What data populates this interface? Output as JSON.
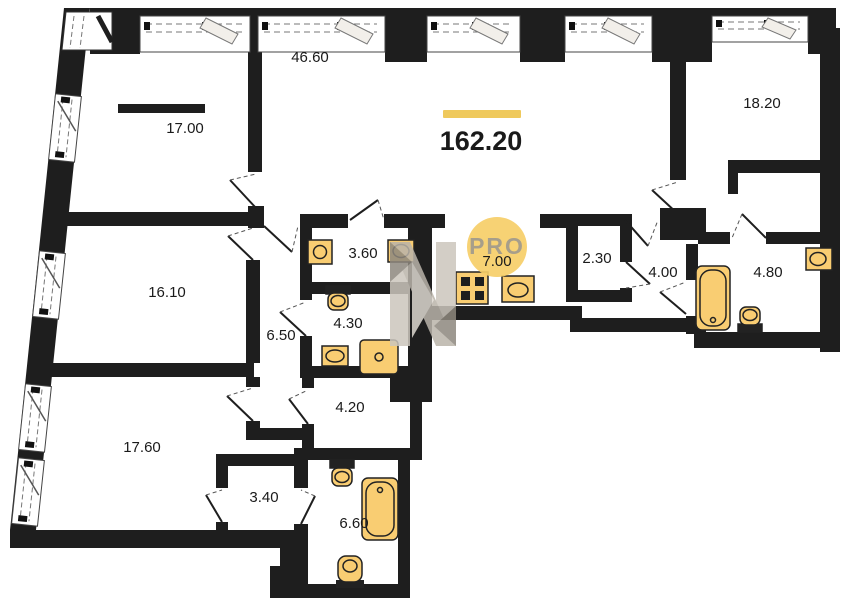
{
  "plan": {
    "type": "apartment-floor-plan",
    "total_area": {
      "value": "162.20",
      "accent_color": "#efc95c"
    },
    "watermark": {
      "text": "PRO",
      "circle_color": "#f6ce68",
      "logo": "faceted-N-logo"
    },
    "rooms": [
      {
        "name": "living-room",
        "area": "46.60"
      },
      {
        "name": "bedroom-top-left",
        "area": "17.00"
      },
      {
        "name": "bedroom-top-right",
        "area": "18.20"
      },
      {
        "name": "bedroom-mid-left",
        "area": "16.10"
      },
      {
        "name": "corridor",
        "area": "6.50"
      },
      {
        "name": "bathroom-a",
        "area": "3.60"
      },
      {
        "name": "bathroom-b",
        "area": "4.30"
      },
      {
        "name": "kitchen",
        "area": "7.00"
      },
      {
        "name": "wardrobe",
        "area": "2.30"
      },
      {
        "name": "hallway",
        "area": "4.00"
      },
      {
        "name": "bathroom-c",
        "area": "4.80"
      },
      {
        "name": "laundry-room",
        "area": "4.20"
      },
      {
        "name": "bathroom-d",
        "area": "6.60"
      },
      {
        "name": "wardrobe-b",
        "area": "3.40"
      },
      {
        "name": "bedroom-bottom-left",
        "area": "17.60"
      }
    ],
    "fixtures": [
      "washing-machine",
      "sink",
      "toilet",
      "shower",
      "stove",
      "bathtub"
    ],
    "colors": {
      "wall": "#1e1e1e",
      "fixture_fill": "#f9cd72",
      "fixture_stroke": "#222222"
    }
  }
}
